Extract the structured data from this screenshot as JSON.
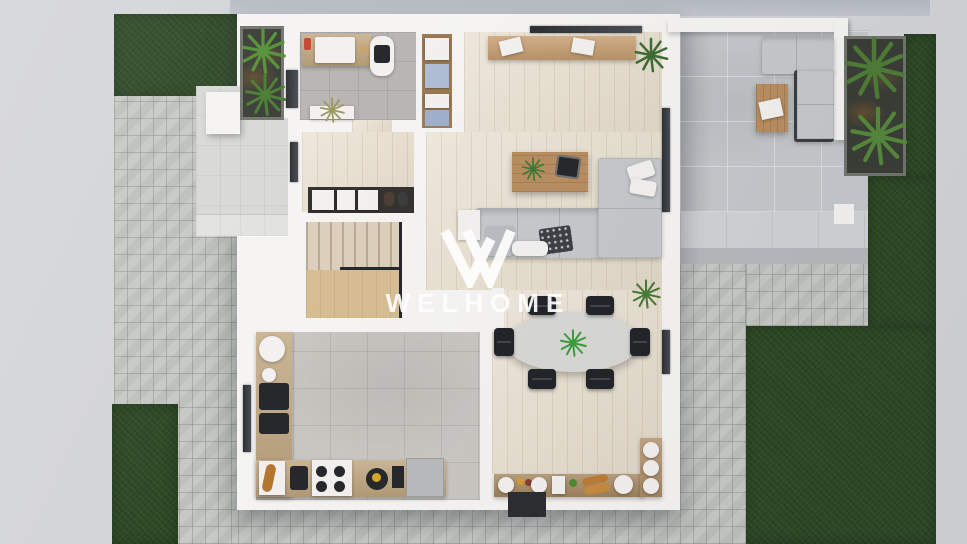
{
  "scene": {
    "description": "top-down 3D rendering of a house ground-floor plan with garden, paved yard and roof terrace",
    "view": "top-down"
  },
  "watermark": {
    "brand": "WELHOME",
    "logo": "w-monogram-icon"
  },
  "palette": {
    "background": "#d4d5d8",
    "backgroundShadow": "#b6bac2",
    "grass": "#2e4a26",
    "paver": "#c3c6c1",
    "paverLine": "rgba(92,98,90,.28)",
    "porch": "#d8d9d6",
    "terraceTile": "#c5c8cb",
    "stepLight": "#d0d2d4",
    "stepDark": "#b6b9bc",
    "wall": "#f5f4f2",
    "woodFloor": "#e8e0d1",
    "woodLine": "rgba(130,100,70,.12)",
    "bathTile": "#b8b5b2",
    "kitchenTile": "#cac7c3",
    "tileLine": "rgba(0,0,0,.08)",
    "counterWood": "#c0a67f",
    "furnitureWood": "#b98e60",
    "sofa": "#c6c8cb",
    "chair": "#212428",
    "tableTop": "#d8d8d5",
    "planterSoil": "#3a3d36",
    "foliage": "#4d7c35",
    "palmGreen": "#559038",
    "driedPlant": "#99995f",
    "towelBlue": "#aebdd4",
    "whiteItem": "#f2f1ef",
    "appliance": "#26282b",
    "mat": "#2b2d30",
    "watermark": "#ffffff"
  },
  "inventory": {
    "regions": [
      "garden-lawn",
      "paved-yard",
      "entry-porch",
      "planter-nook",
      "bathroom",
      "linen-closet",
      "home-office",
      "living-room",
      "hallway",
      "staircase",
      "kitchen",
      "dining-area",
      "terrace",
      "fern-planter"
    ],
    "dining_chairs": 6,
    "indoor_sofa_sections": 2,
    "outdoor_sofa_sections": 2,
    "plants": 7
  }
}
